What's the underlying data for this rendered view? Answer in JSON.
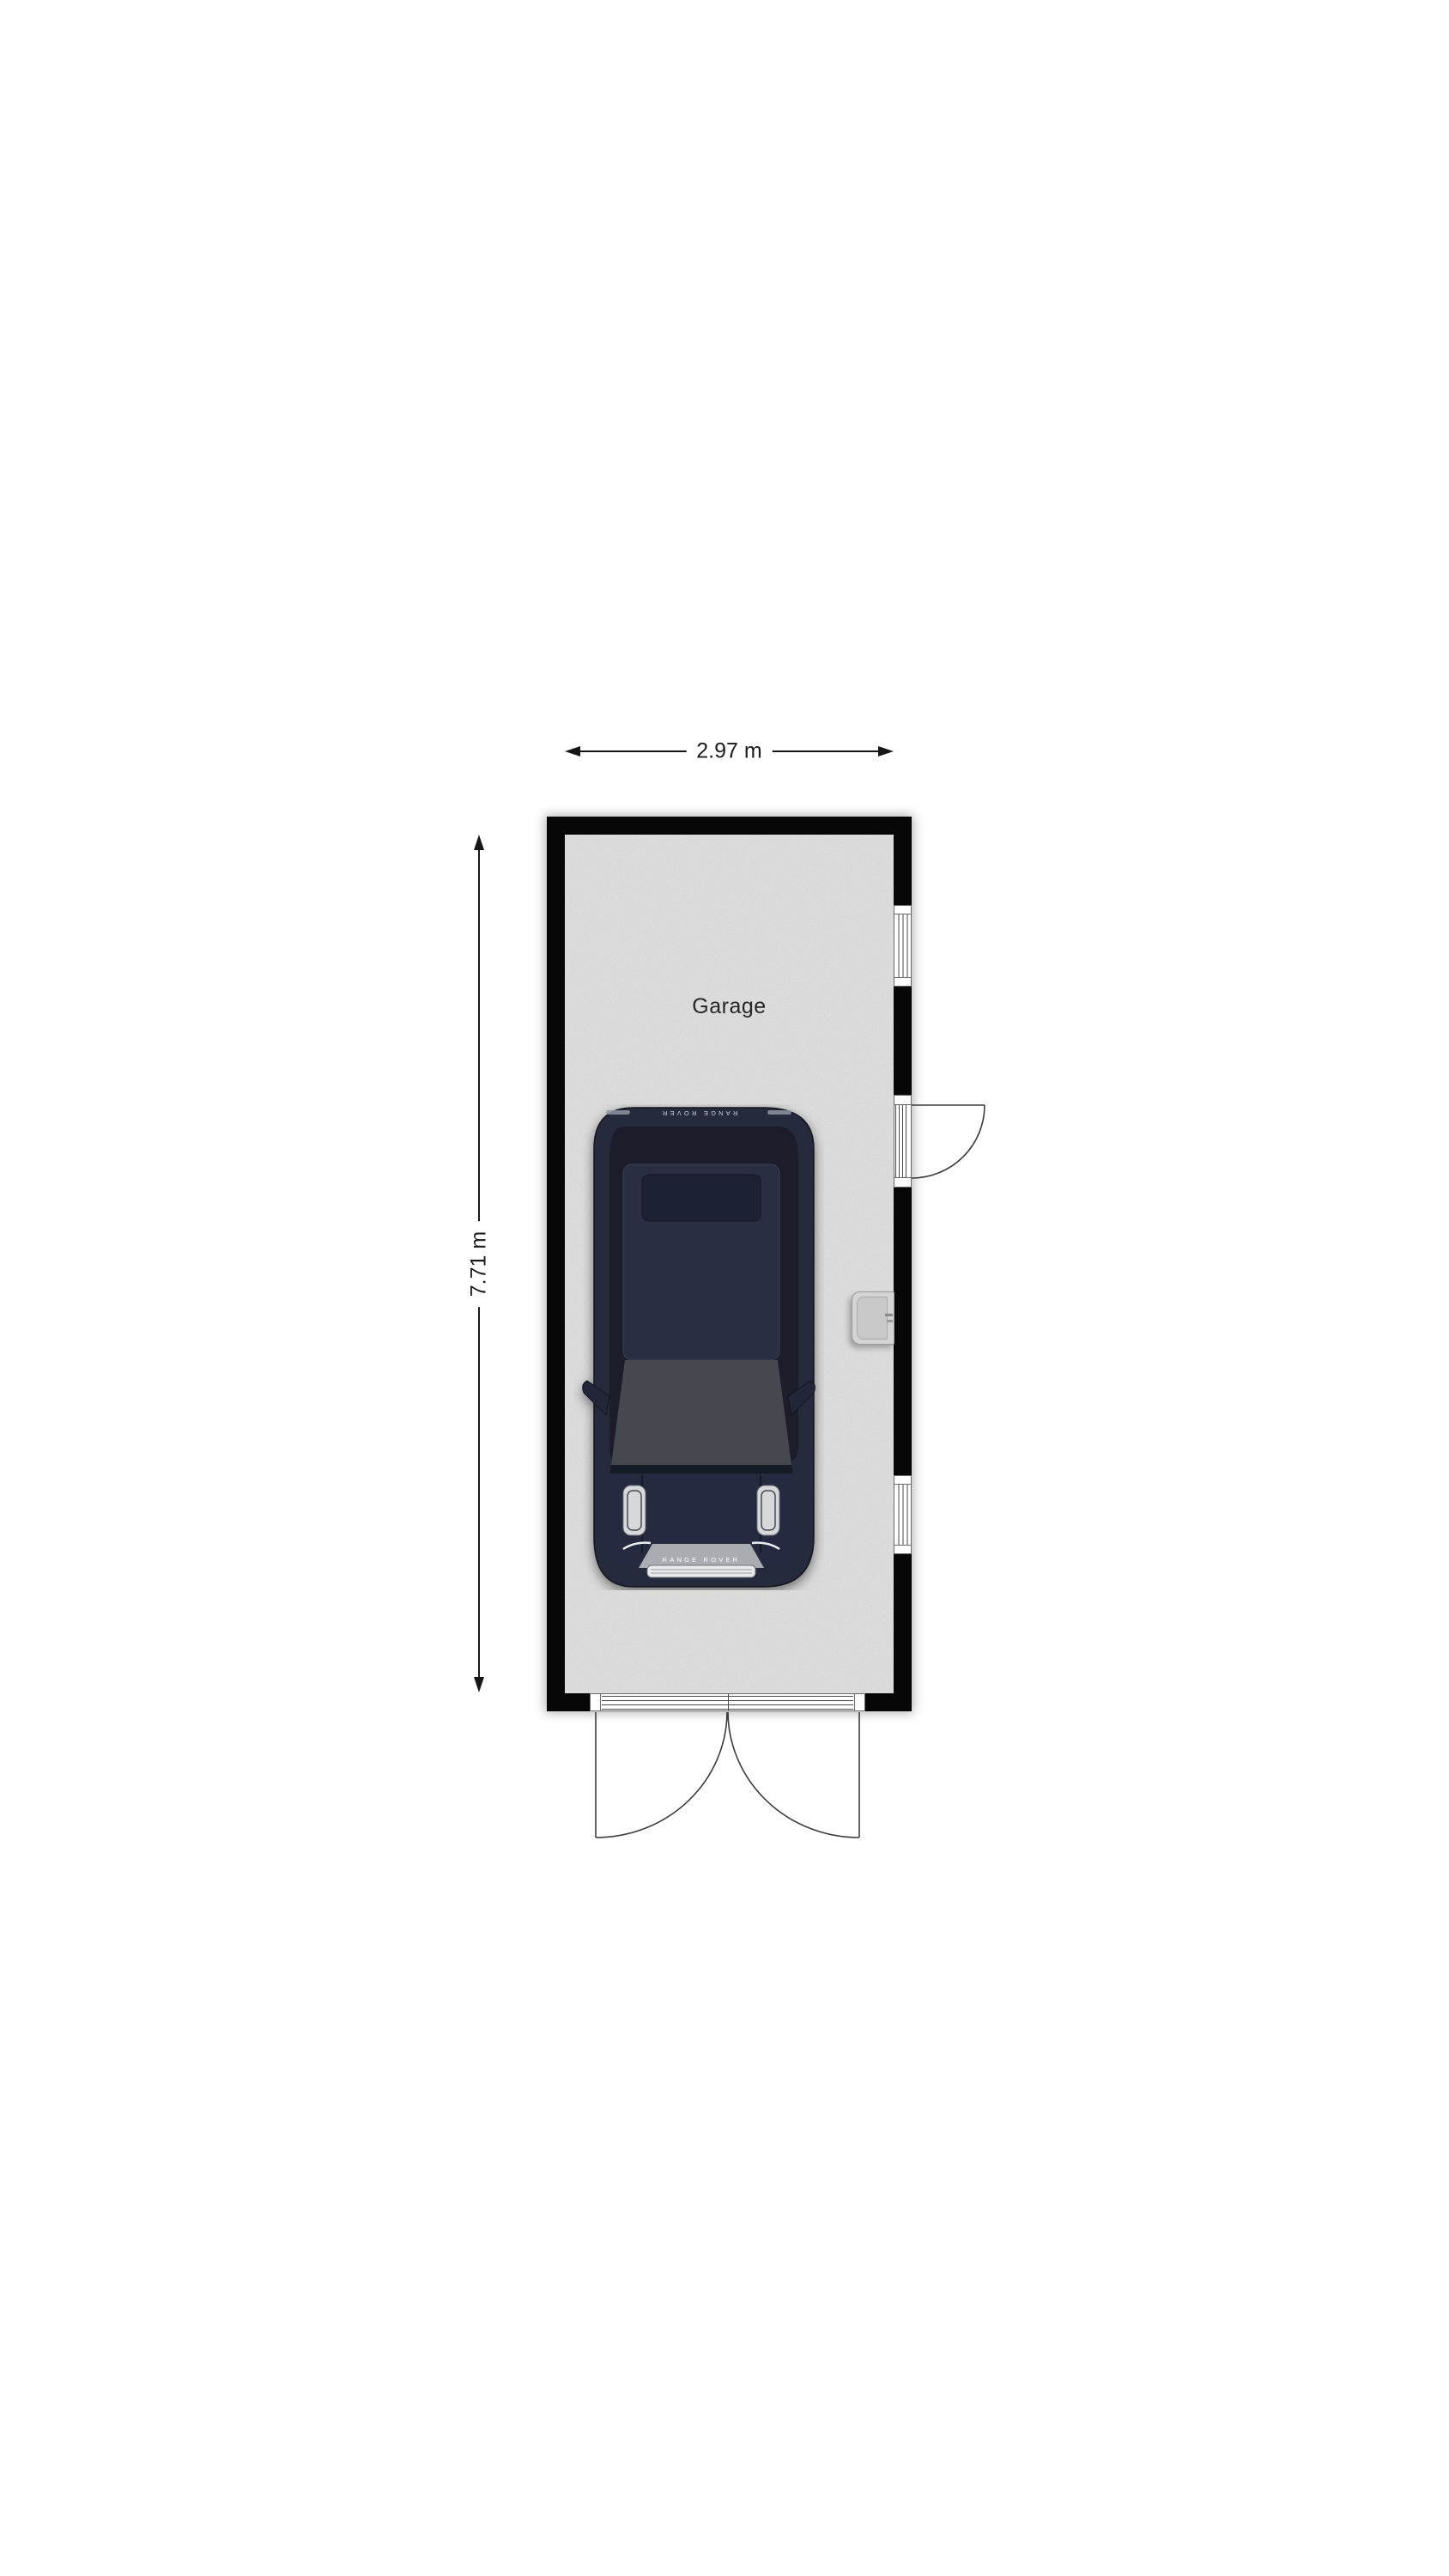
{
  "floorplan": {
    "room": {
      "label": "Garage",
      "floor_color": "#b4b4b4",
      "wall_color": "#070707",
      "background_color": "#ffffff"
    },
    "dimensions": {
      "width_label": "2.97 m",
      "height_label": "7.71 m",
      "line_color": "#161616"
    },
    "car": {
      "rear_badge": "RANGE ROVER",
      "front_badge": "RANGE ROVER",
      "body_color": "#262b3e",
      "glass_color": "#1a1e2c",
      "roof_color": "#2a2f42",
      "windshield_color": "#45484f",
      "trim_silver": "#a9adb1"
    },
    "openings": {
      "right_wall_windows": 2,
      "right_wall_single_door": 1,
      "bottom_double_door": 1
    },
    "fixture": {
      "type": "wall-sink",
      "color": "#d4d4d4"
    }
  }
}
